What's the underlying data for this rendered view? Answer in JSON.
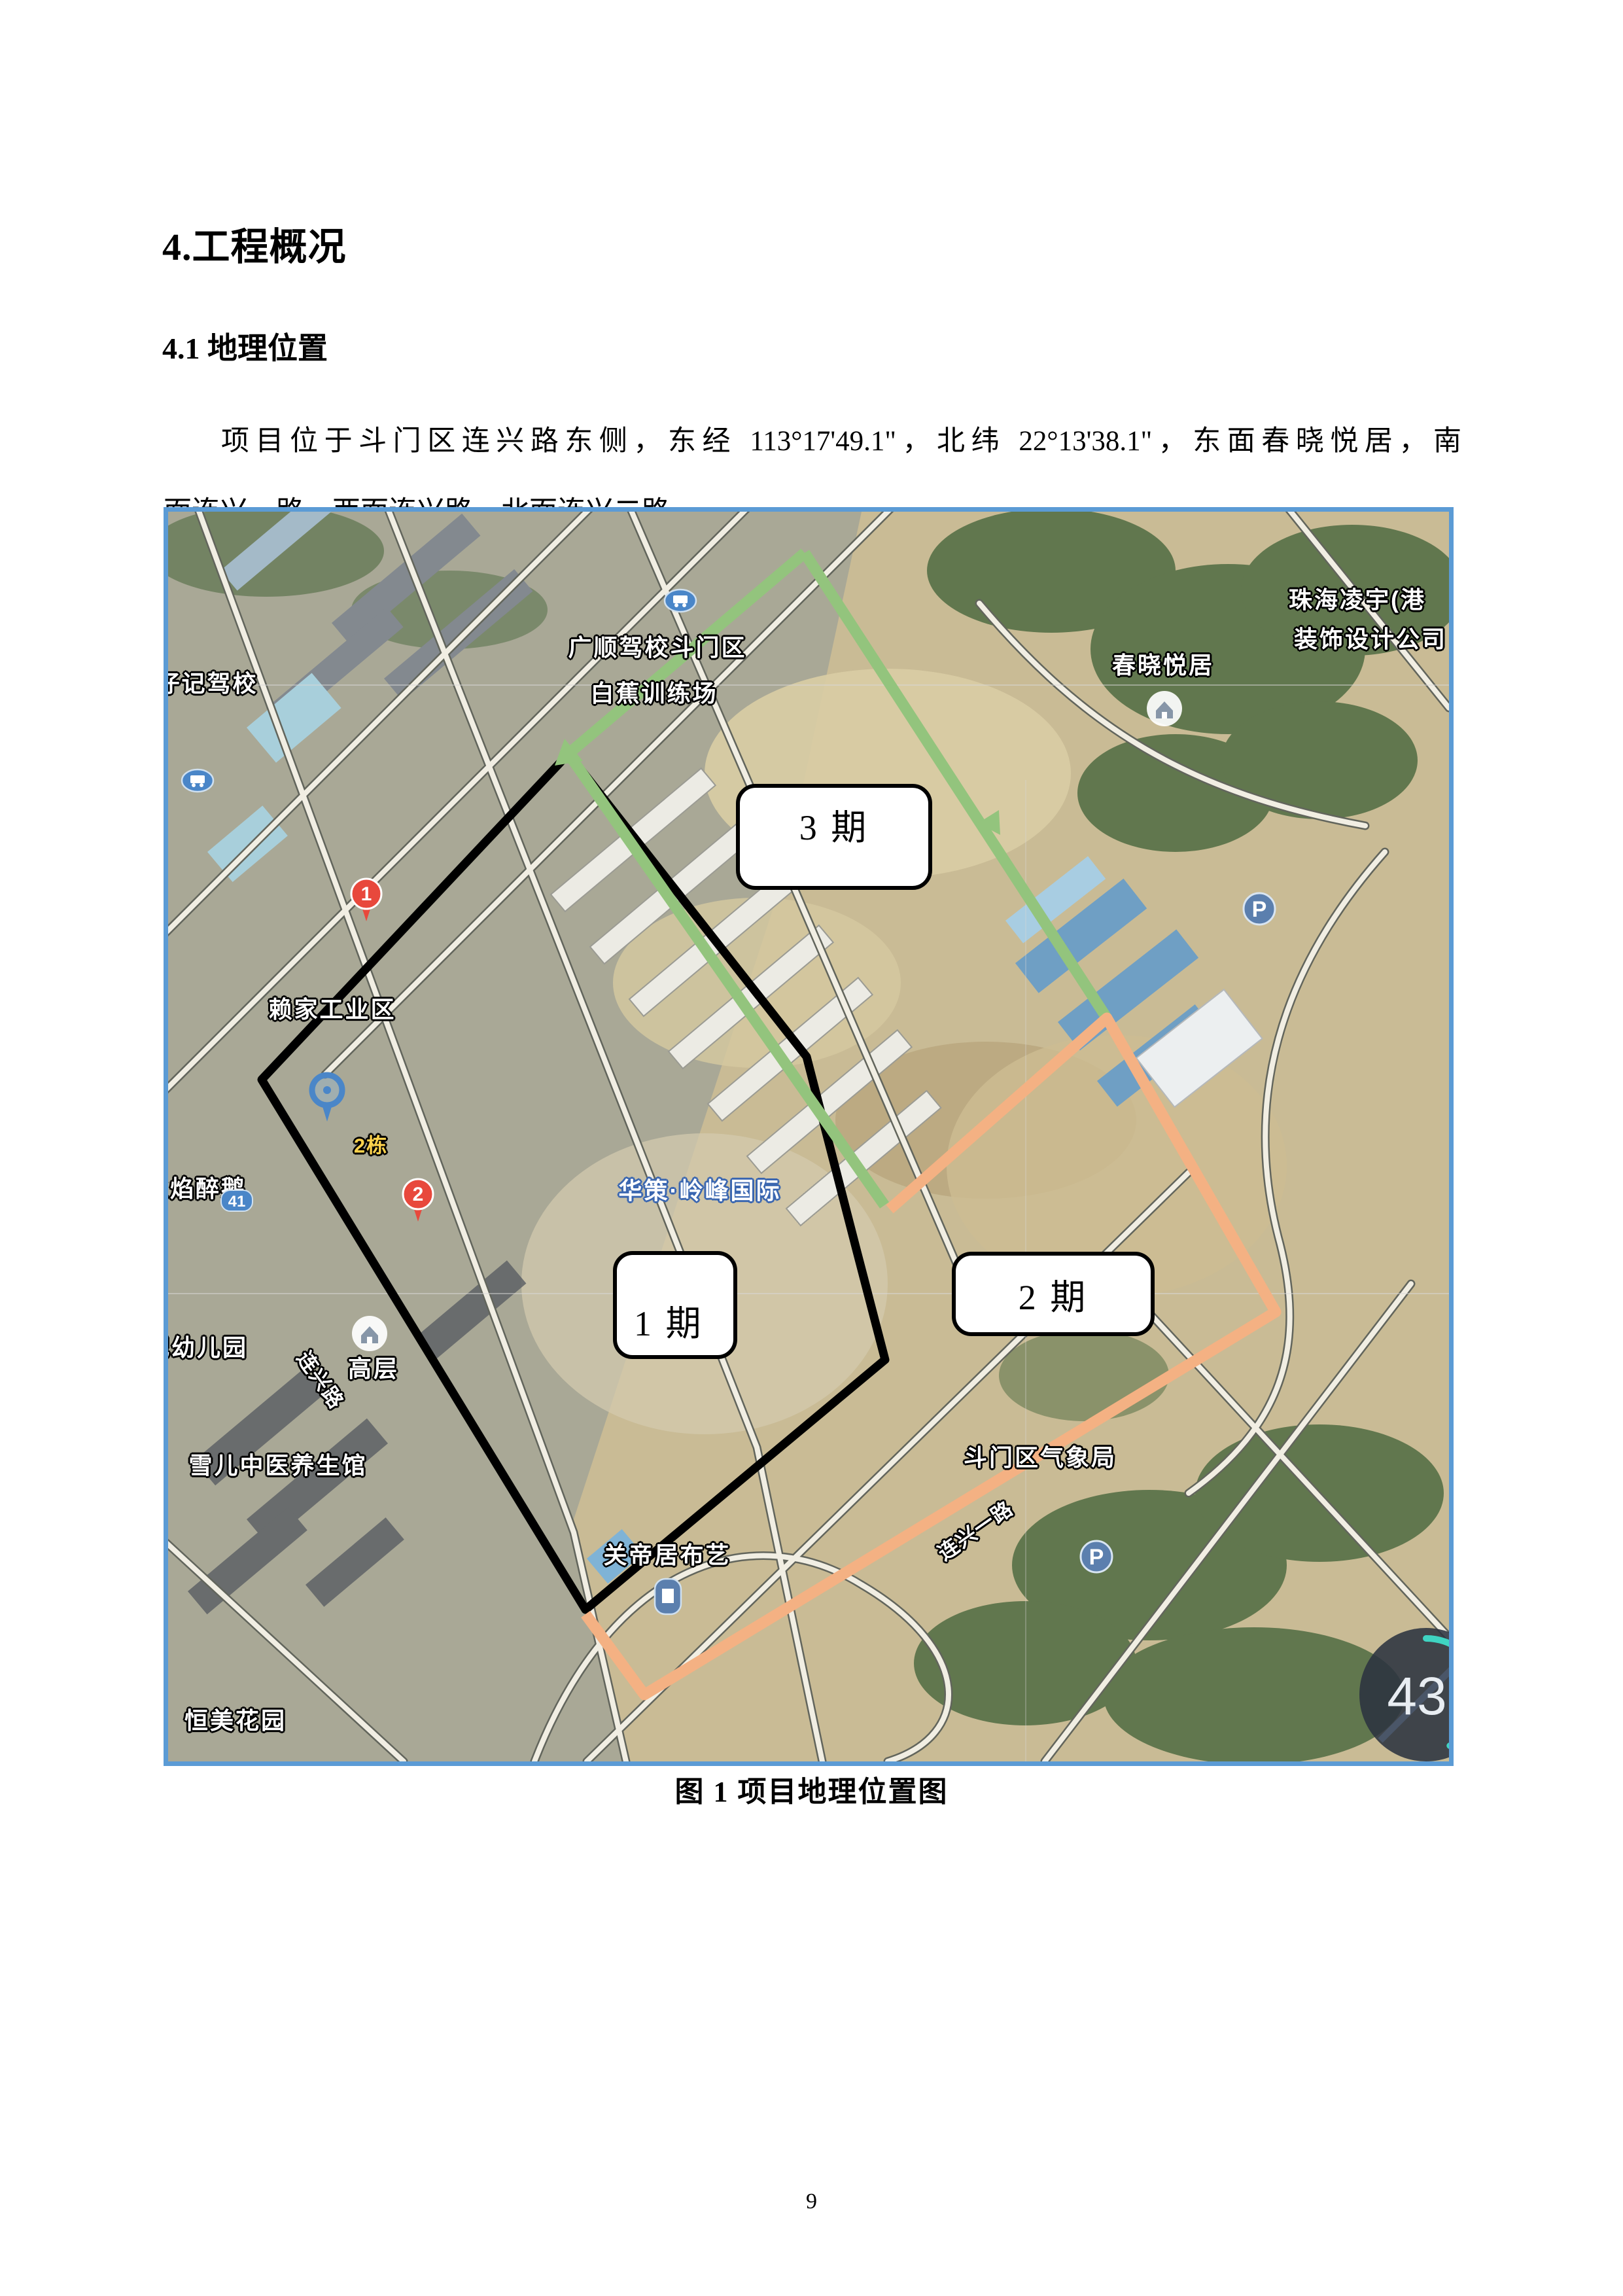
{
  "document": {
    "heading1": "4.工程概况",
    "heading2": "4.1 地理位置",
    "paragraph_line1": "项目位于斗门区连兴路东侧，东经 113°17'49.1\"，北纬 22°13'38.1\"，东面春晓悦居，南",
    "paragraph_line2": "面连兴一路、西面连兴路、北面连兴二路。",
    "figure_caption": "图 1 项目地理位置图",
    "page_number": "9"
  },
  "map": {
    "phases": [
      {
        "id": "phase-3",
        "label": "3 期"
      },
      {
        "id": "phase-1",
        "label": "1 期"
      },
      {
        "id": "phase-2",
        "label": "2 期"
      }
    ],
    "landmarks": {
      "zhuhai_lingyu_l1": "珠海凌宇(港",
      "zhuhai_lingyu_l2": "装饰设计公司",
      "chunxiao": "春晓悦居",
      "guangshun_l1": "广顺驾校斗门区",
      "guangshun_l2": "白蕉训练场",
      "fazaiji": "发仔记驾校",
      "laijia": "赖家工业区",
      "dong2": "2栋",
      "huace": "华策·岭峰国际",
      "huoyan": "火焰醉鹅",
      "gaoceng": "高层",
      "youeryuan": "纪幼儿园",
      "xueer": "雪儿中医养生馆",
      "lianxinglu": "连兴路",
      "guandi": "关帝居布艺",
      "qixiangju": "斗门区气象局",
      "lianxingyilu": "连兴一路",
      "hengmei": "恒美花园"
    },
    "markers": {
      "pin1": "1",
      "pin2": "2",
      "badge41": "41",
      "parking": "P"
    },
    "gauge": {
      "value": "43",
      "unit": "%"
    },
    "colors": {
      "phase1_line": "#000000",
      "phase2_line": "#f4b183",
      "phase3_line": "#93c47d",
      "map_border": "#5b9bd5",
      "gauge_arc": "#3fd4c2"
    }
  }
}
